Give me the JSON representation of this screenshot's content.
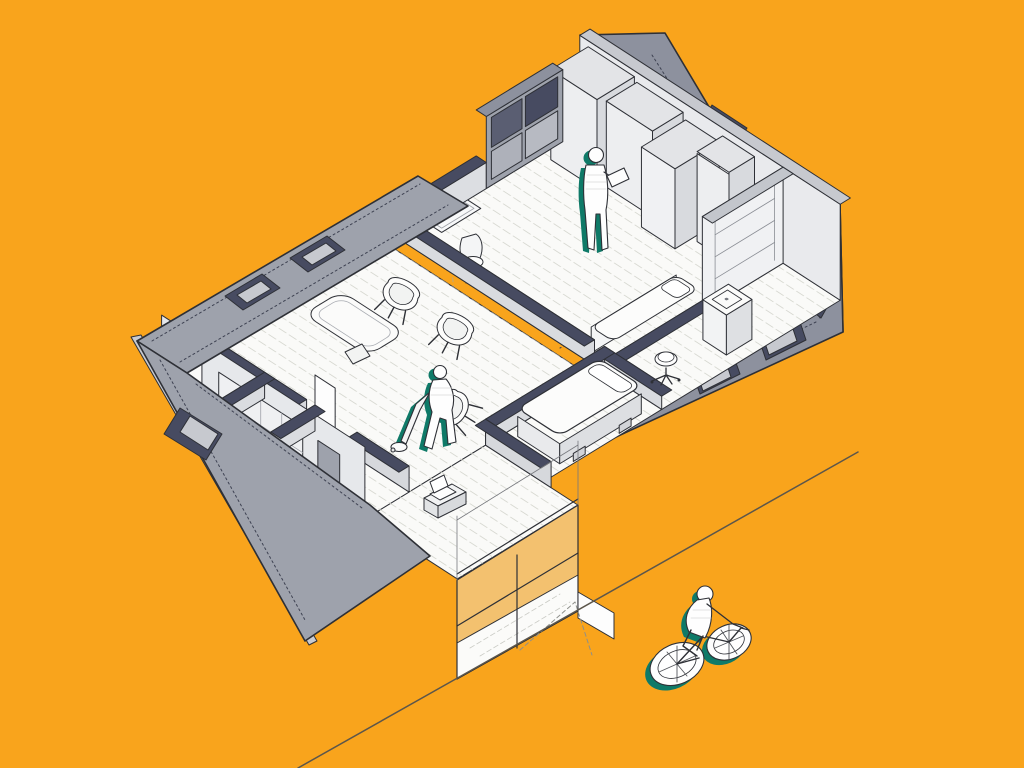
{
  "scene": {
    "type": "axonometric-cutaway-apartment-illustration",
    "background": "#F9A41C",
    "palette": {
      "roof_gray": "#8D919E",
      "wing_gray": "#9EA2AC",
      "parapet_light": "#C7C9CF",
      "navy_recess": "#474B61",
      "navy_deep": "#3E4252",
      "wall_face": "#E9EAED",
      "wall_face_dim": "#DCDEE2",
      "wall_side": "#D8DADE",
      "floor_white": "#FAFAF8",
      "hatch_line": "#D8D9D2",
      "outline": "#2E3036",
      "accent_teal": "#0F7A68",
      "street_line": "#5C564B",
      "dashed_cut": "#BDA87F",
      "glass_tint": "rgba(235,242,246,0.38)"
    },
    "figures": [
      {
        "name": "person-standing-reading",
        "location": "bedroom"
      },
      {
        "name": "person-vacuuming",
        "location": "hallway"
      },
      {
        "name": "cyclist",
        "location": "street"
      }
    ],
    "rooms": [
      "bedroom",
      "bathroom",
      "treatment-room",
      "waiting-room",
      "hallway",
      "entrance-vestibule",
      "neighbor-wing-roof"
    ],
    "furniture": [
      "wardrobes",
      "bookshelf",
      "bench-bed",
      "desk",
      "office-chair",
      "washbasin",
      "swivel-stool",
      "massage-table",
      "armchairs",
      "side-cabinet",
      "laptop",
      "glass-partition",
      "doors"
    ]
  }
}
